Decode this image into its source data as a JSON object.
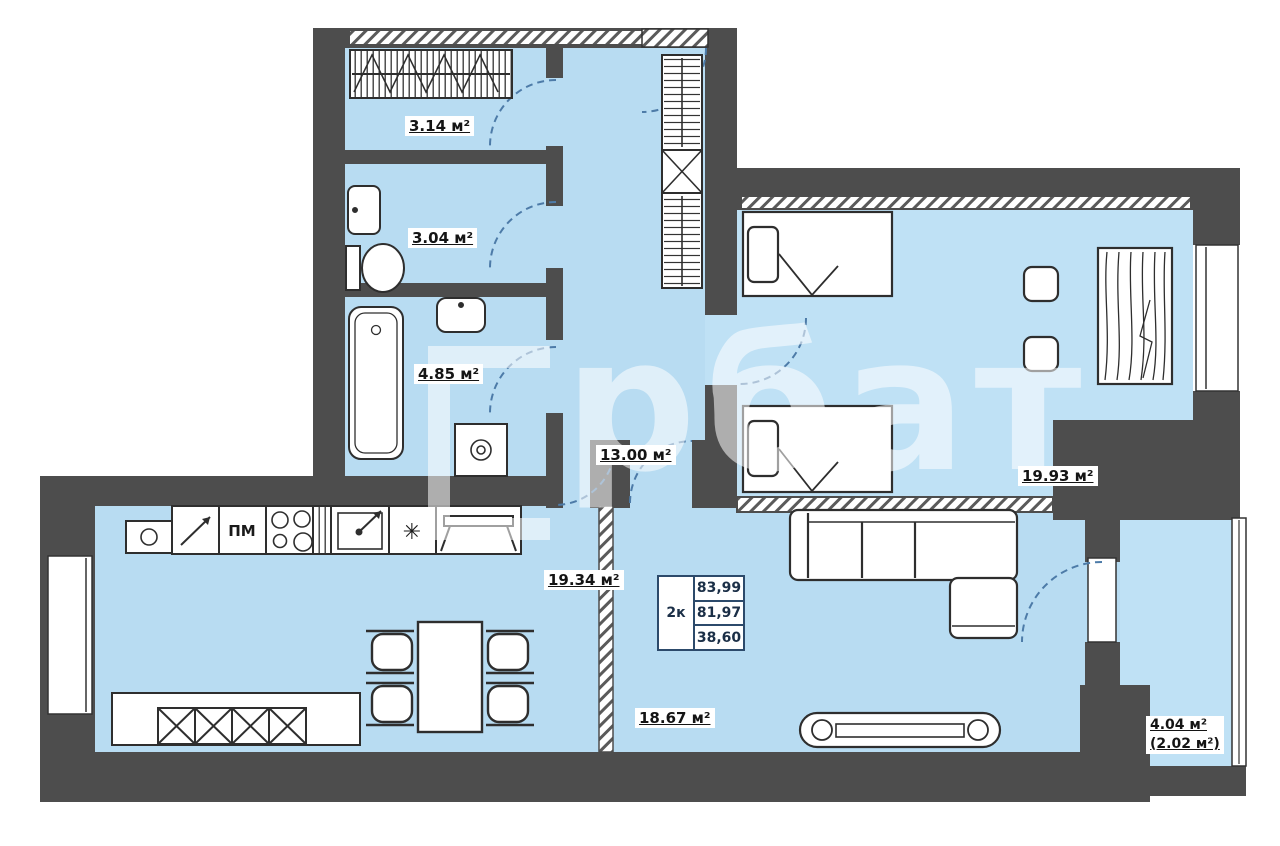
{
  "title": "2-room apartment floor plan",
  "colors": {
    "wall": "#4d4d4d",
    "floor": "#b8dcf2",
    "line": "#2e2e2e",
    "door_arc": "#4d7ba8",
    "table_border": "#2c4a6b"
  },
  "rooms": {
    "closet": {
      "area": "3.14 м²"
    },
    "wc": {
      "area": "3.04 м²"
    },
    "bathroom": {
      "area": "4.85 м²"
    },
    "hallway": {
      "area": "13.00 м²"
    },
    "bedroom": {
      "area": "19.93 м²"
    },
    "kitchen": {
      "area": "19.34 м²"
    },
    "living_room": {
      "area": "18.67 м²"
    },
    "balcony": {
      "area": "4.04 м²",
      "area_reduced": "(2.02 м²)"
    }
  },
  "info_table": {
    "apartment_type": "2к",
    "rows": [
      "83,99",
      "81,97",
      "38,60"
    ]
  },
  "kitchen_labels": {
    "dishwasher": "ПМ",
    "fridge_symbol": "✳"
  },
  "watermark": {
    "text": "рбат"
  }
}
